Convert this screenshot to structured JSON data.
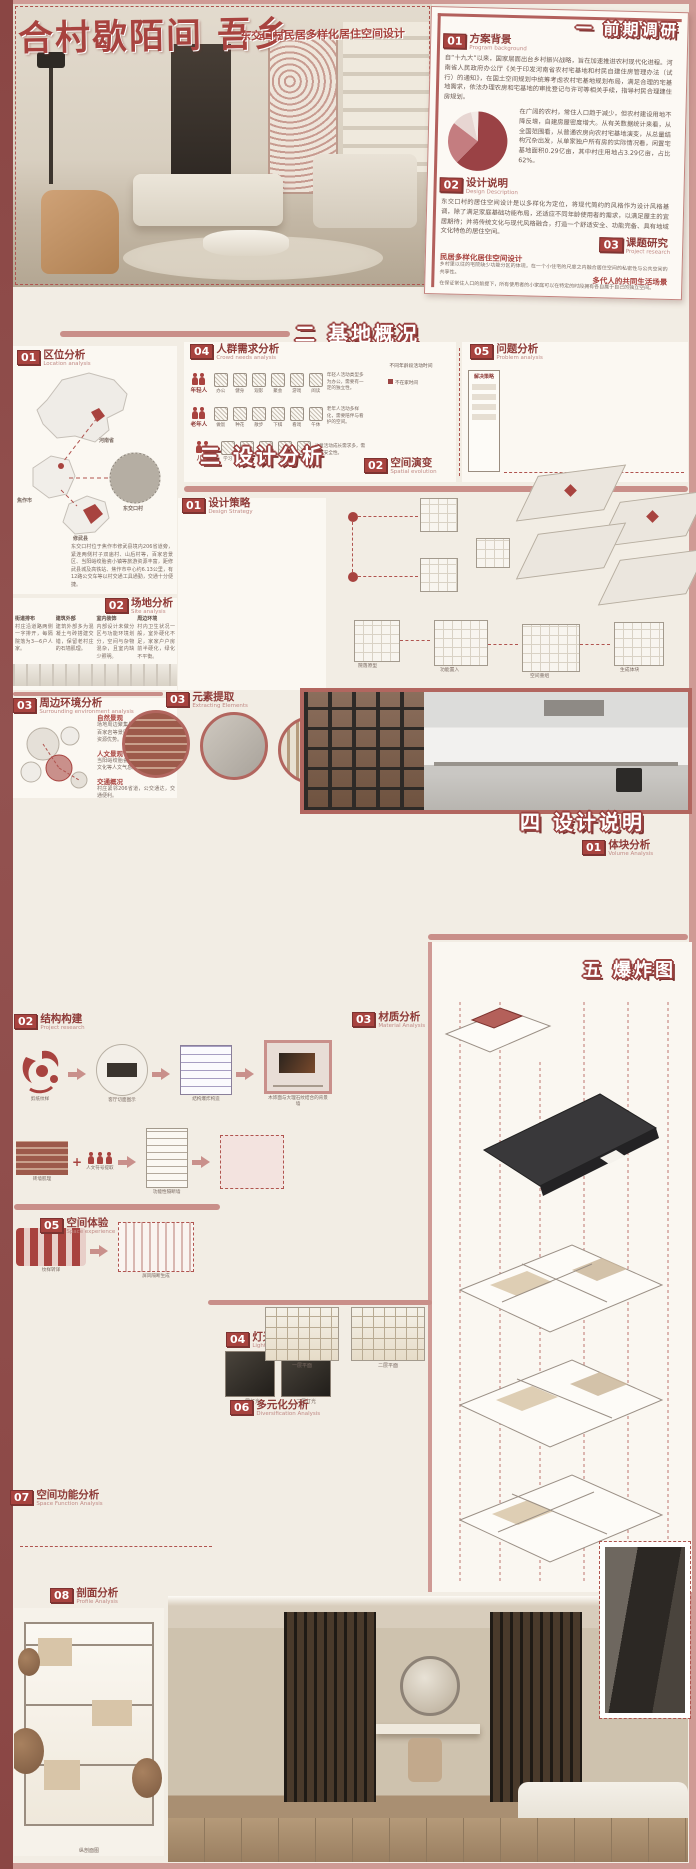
{
  "poster": {
    "title": "合村歇陌间 吾乡",
    "subtitle": "东交口村民居多样化居住空间设计"
  },
  "colors": {
    "accent": "#a8433f",
    "frame": "#cf9a95",
    "maroon": "#8a4644",
    "block_red": "#b4605a",
    "cream": "#f2ede4"
  },
  "chapters": {
    "c1": {
      "label": "一  前期调研"
    },
    "c2": {
      "label": "二  基地概况"
    },
    "c3": {
      "label": "三  设计分析"
    },
    "c4": {
      "label": "四  设计说明"
    },
    "c5": {
      "label": "五  爆炸图"
    }
  },
  "c1": {
    "bg": {
      "num": "01",
      "cn": "方案背景",
      "en": "Program background",
      "p1": "自“十九大”以来，国家层面出台乡村振兴战略，旨在加速推进农村现代化进程。河南省人民政府办公厅《关于印发河南省农村宅基地和村民自建住房管理办法（试行）的通知》，在国土空间规划中统筹考虑农村宅基地规划布局，满足合理的宅基地需求，依法办理农房和宅基地的审批登记与许可等相关手续，指导村民合理建住房规划。",
      "p2": "在广阔的农村，常住人口趋于减少，但农村建设用地不降反增，自建房屋密度增大。从有关数据统计来看，从全国范围看，从普通农房向农村宅基地演变，从总量结构冗杂出发，从单家独户所有房的实际情况看，闲置宅基地面积0.29亿亩，其中村庄用地占3.29亿亩，占比62%。"
    },
    "pie": {
      "values": [
        62,
        23,
        11,
        4
      ],
      "colors": [
        "#9a4245",
        "#c47d80",
        "#e7d6d2",
        "#f3eae6"
      ],
      "note": "62%"
    },
    "desc": {
      "num": "02",
      "cn": "设计说明",
      "en": "Design Description",
      "p": "东交口村的居住空间设计是以多样化为定位，将现代简约的风格作为设计风格基调，除了满足家庭基础功能布局，还适应不同年龄使用者的需求，以满足屋主的宜居期待；并将传统文化与现代风格融合，打造一个舒适安全、功能完备、具有地域文化特色的居住空间。"
    },
    "research": {
      "num": "03",
      "cn": "课题研究",
      "en": "Project research",
      "t1": "民居多样化居住空间设计",
      "p1": "乡村里以往的宅院缺少功能分区的体现，在一个小住宅的尺度之内融合居住空间的私密性与公共空间的共享性。",
      "t2": "多代人的共同生活场景",
      "p2": "在保证常住人口的前提下，所有使用者的小家庭可以在特定的时段拥有各自属于自己的独立空间。"
    }
  },
  "c2": {
    "loc": {
      "num": "01",
      "cn": "区位分析",
      "en": "Location analysis",
      "labels": {
        "province": "河南省",
        "city": "焦作市",
        "village": "东交口村",
        "county": "修武县"
      },
      "p": "东交口村位于焦作市修武县境内206省道旁，紧连两侧村子双庙村、山后村等，百家岩景区、当阳峪绞胎瓷小镇等旅游资源丰富，距修武县城及高铁站、焦作市中心约6.13公里，有12路公交车等以村交通工具通勤，交通十分便捷。"
    },
    "site": {
      "num": "02",
      "cn": "场地分析",
      "en": "Site analysis",
      "cols": [
        {
          "t": "街道排布",
          "d": "村庄沿道路两侧一字排开，每隔院落为3—6户人家。"
        },
        {
          "t": "建筑外部",
          "d": "建筑外部多为混凝土与砖搭建交错，保留老村庄的石墙肌理。"
        },
        {
          "t": "室内装饰",
          "d": "内部设计未做分区与功能环境划分，空间与杂物混杂，且室内缺少照明。"
        },
        {
          "t": "周边环境",
          "d": "村内卫生状况一般，室外硬化不足，家家户户房前半硬化，绿化不平衡。"
        }
      ]
    },
    "env": {
      "num": "03",
      "cn": "周边环境分析",
      "en": "Surrounding environment analysis",
      "items": [
        {
          "t": "自然景观",
          "d": "场地周边聚集景观资源，云台山、百家岩等景区环绕，是场地的自然资源优势。"
        },
        {
          "t": "人文景观",
          "d": "当阳峪绞胎瓷文化、竹林七贤隐居文化等人文气息浓厚。"
        },
        {
          "t": "交通概况",
          "d": "村庄紧邻206省道，公交通达，交通便利。"
        }
      ]
    },
    "crowd": {
      "num": "04",
      "cn": "人群需求分析",
      "en": "Crowd needs analysis",
      "rows": [
        {
          "group": "年轻人",
          "acts": [
            "办公",
            "健身",
            "观影",
            "聚会",
            "游戏",
            "阅读"
          ],
          "note": "年轻人活动类型多为办公，需要有一定的独立性。"
        },
        {
          "group": "老年人",
          "acts": [
            "做饭",
            "种花",
            "散步",
            "下棋",
            "看戏",
            "午休"
          ],
          "note": "老年人活动多样化，需要陪伴与看护的空间。"
        },
        {
          "group": "儿童",
          "acts": [
            "学习",
            "绘画",
            "玩耍",
            "游戏",
            "手工"
          ],
          "note": "儿童活动成长需求多，需注意安全性。"
        }
      ],
      "chart": {
        "type": "bar",
        "title": "不同年龄段活动时间",
        "ticks": [
          0,
          2,
          4,
          6,
          8,
          10,
          12,
          14,
          16,
          18,
          20,
          22,
          24
        ],
        "legend": "不在家时间",
        "colors": {
          "away": "#9c4543",
          "mid": "#c9908b",
          "home": "#e9dcd7"
        },
        "rows": [
          {
            "label": "年轻人",
            "segs": [
              [
                0,
                7,
                "home"
              ],
              [
                7,
                19,
                "away"
              ],
              [
                19,
                24,
                "mid"
              ]
            ]
          },
          {
            "label": "老年人",
            "segs": [
              [
                0,
                6,
                "home"
              ],
              [
                6,
                9,
                "away"
              ],
              [
                9,
                14,
                "mid"
              ],
              [
                14,
                17,
                "away"
              ],
              [
                17,
                24,
                "home"
              ]
            ]
          },
          {
            "label": "儿童",
            "segs": [
              [
                0,
                8,
                "home"
              ],
              [
                8,
                12,
                "away"
              ],
              [
                12,
                14,
                "mid"
              ],
              [
                14,
                17,
                "away"
              ],
              [
                17,
                24,
                "home"
              ]
            ]
          }
        ]
      }
    },
    "problem": {
      "num": "05",
      "cn": "问题分析",
      "en": "Problem analysis",
      "box": "解决策略",
      "bars": [
        46,
        28,
        38,
        24,
        42
      ]
    }
  },
  "c3": {
    "strategy": {
      "num": "01",
      "cn": "设计策略",
      "en": "Design Strategy",
      "items": [
        "庭院",
        "公共空间",
        "休闲空间",
        "娱乐空间",
        "住宅空间",
        "隔断",
        "天井",
        "室内台阶",
        "盒子"
      ]
    },
    "evolution": {
      "num": "02",
      "cn": "空间演变",
      "en": "Spatial evolution",
      "nodes": [
        "院落原型",
        "功能置入",
        "空间重组",
        "生成体块"
      ]
    },
    "elements": {
      "num": "03",
      "cn": "元素提取",
      "en": "Extracting Elements"
    }
  },
  "c4": {
    "volume": {
      "num": "01",
      "cn": "体块分析",
      "en": "Volume Analysis",
      "labels": [
        "原始体块",
        "体块切割",
        "客厅抬升",
        "餐厨置入",
        "庭院嵌入",
        "楼梯连接",
        "露台生成",
        "最终形态"
      ]
    },
    "structure": {
      "num": "02",
      "cn": "结构构建",
      "en": "Project research",
      "steps": [
        "剪纸纹样",
        "客厅切面图示",
        "结构爆炸构造",
        "木饰面与大理石纹结合的背景墙"
      ],
      "steps2": [
        "砖墙肌理",
        "人文符号提取",
        "功能性隔断墙"
      ],
      "steps3": [
        "纹样转译",
        "屏风隔断生成"
      ]
    },
    "material": {
      "num": "03",
      "cn": "材质分析",
      "en": "Material Analysis",
      "swatches": [
        {
          "t": "生态木饰面",
          "c": "#c8a885"
        },
        {
          "t": "原木横纹",
          "c": "#a9805f"
        },
        {
          "t": "爵士白大理石",
          "c": "#e3e0db"
        },
        {
          "t": "米色水磨石",
          "c": "#d8cfc4"
        },
        {
          "t": "灰色水磨石",
          "c": "#b9b4ae"
        },
        {
          "t": "胡桃木饰面",
          "c": "#7b5a43"
        },
        {
          "t": "红砖肌理",
          "c": "#9d5a4b"
        },
        {
          "t": "深色木纹",
          "c": "#5f4636"
        }
      ]
    },
    "light": {
      "num": "04",
      "cn": "灯光分析",
      "en": "Light analysis",
      "caps": [
        "一层灯光",
        "二层灯光"
      ]
    },
    "plans": {
      "caps": [
        "一层平面",
        "二层平面"
      ]
    },
    "experience": {
      "num": "05",
      "cn": "空间体验",
      "en": "Space experience"
    },
    "diverse": {
      "num": "06",
      "cn": "多元化分析",
      "en": "Diversification Analysis",
      "modes": [
        {
          "t": "养老模式",
          "d": "子女外出务工后，老人与三代同堂并存，首层设置适老化起居与休憩空间。"
        },
        {
          "t": "聚会度假模式",
          "d": "节假日亲友返乡聚会，一层中部空间可合并为开敞的聚会客厅与公共餐厨。"
        },
        {
          "t": "小作坊模式",
          "d": "宅院部分空间可转化为手工作坊，满足村民生产与展示售卖需求。"
        },
        {
          "t": "度假模式",
          "d": "闲置房间转化为民宿客房，为游客提供乡村度假的居住体验。"
        }
      ]
    },
    "func": {
      "num": "07",
      "cn": "空间功能分析",
      "en": "Space Function Analysis",
      "nodes": [
        "休憩",
        "劳作",
        "学习",
        "聚会",
        "合作"
      ]
    },
    "profile": {
      "num": "08",
      "cn": "剖面分析",
      "en": "Profile Analysis",
      "caps": [
        "纵剖面图",
        "横剖面图"
      ]
    }
  }
}
